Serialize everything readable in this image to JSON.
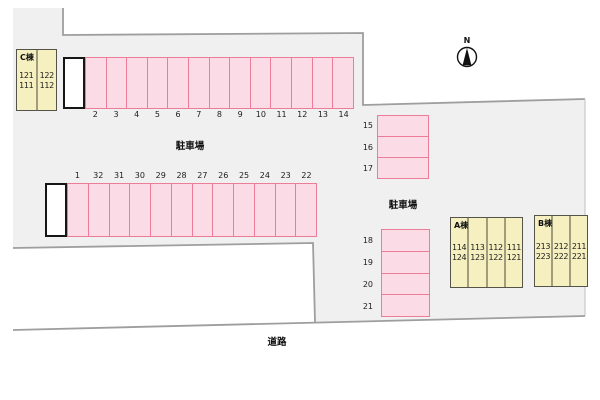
{
  "labels": {
    "north": "N",
    "parking_area_top": "駐車場",
    "parking_area_right": "駐車場",
    "road": "道路"
  },
  "parking": {
    "top_row": {
      "spaces": [
        "2",
        "3",
        "4",
        "5",
        "6",
        "7",
        "8",
        "9",
        "10",
        "11",
        "12",
        "13",
        "14"
      ]
    },
    "middle_row": {
      "spaces": [
        "1",
        "32",
        "31",
        "30",
        "29",
        "28",
        "27",
        "26",
        "25",
        "24",
        "23",
        "22"
      ]
    },
    "right_upper_stack": {
      "spaces": [
        "15",
        "16",
        "17"
      ]
    },
    "right_lower_stack": {
      "spaces": [
        "18",
        "19",
        "20",
        "21"
      ]
    }
  },
  "buildings": {
    "c": {
      "label": "C棟",
      "columns": [
        [
          "121",
          "111"
        ],
        [
          "122",
          "112"
        ]
      ]
    },
    "a": {
      "label": "A棟",
      "columns": [
        [
          "114",
          "124"
        ],
        [
          "113",
          "123"
        ],
        [
          "112",
          "122"
        ],
        [
          "111",
          "121"
        ]
      ]
    },
    "b": {
      "label": "B棟",
      "columns": [
        [
          "213",
          "223"
        ],
        [
          "212",
          "222"
        ],
        [
          "211",
          "221"
        ]
      ]
    }
  },
  "colors": {
    "site_fill": "#f0f0f0",
    "boundary_line": "#9e9e9e",
    "space_fill": "#fbdce6",
    "space_border": "#ec7d99",
    "building_fill": "#f6f0c0",
    "building_border": "#55544a",
    "building_divider": "#a09d7e",
    "stall_border": "#161616"
  }
}
